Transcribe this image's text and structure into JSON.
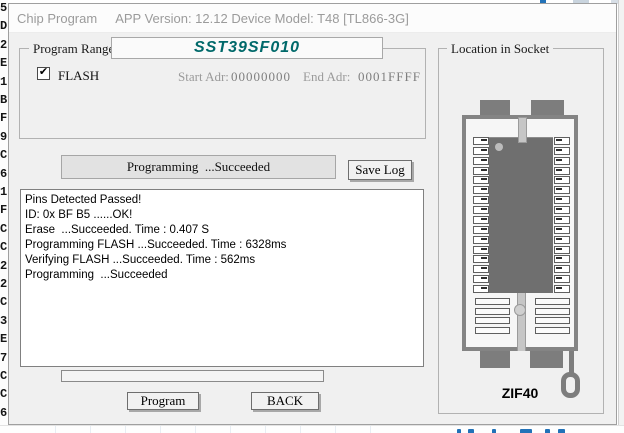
{
  "window": {
    "title_left": "Chip Program",
    "title_right": "APP Version: 12.12 Device Model: T48 [TL866-3G]"
  },
  "program_range": {
    "group_label": "Program Range",
    "chip_name": "SST39SF010",
    "flash_checkbox": {
      "label": "FLASH",
      "checked": true
    },
    "start_adr_label": "Start Adr:",
    "start_adr_value": "00000000",
    "end_adr_label": "End Adr:",
    "end_adr_value": "0001FFFF"
  },
  "status": {
    "message": "Programming  ...Succeeded",
    "save_log_button": "Save Log"
  },
  "log": {
    "lines": [
      "Pins Detected Passed!",
      "ID: 0x BF B5 ......OK!",
      "Erase  ...Succeeded. Time : 0.407 S",
      "Programming FLASH ...Succeeded. Time : 6328ms",
      "Verifying FLASH ...Succeeded. Time : 562ms",
      "Programming  ...Succeeded"
    ]
  },
  "progress": {
    "value_percent": 0
  },
  "actions": {
    "program_button": "Program",
    "back_button": "BACK"
  },
  "socket_panel": {
    "group_label": "Location in Socket",
    "socket_label": "ZIF40",
    "pin_rows_covered": 16,
    "pin_rows_empty": 4
  },
  "icons": {
    "checkbox_check": "✔"
  },
  "background_window": {
    "left_column_chars": [
      "5",
      "D",
      "2",
      "E",
      "1",
      "B",
      "F",
      "9",
      "C",
      "6",
      "1",
      "F",
      "C",
      "C",
      "2",
      "2",
      "C",
      "3",
      "E",
      "7",
      "C",
      "C",
      "6",
      "8"
    ],
    "accent_blue": "#2272b8"
  },
  "colors": {
    "chip_name_teal": "#00696a",
    "dialog_bg": "#f0f0f0",
    "titlebar_text": "#9b9b9b",
    "socket_gray": "#7d7d7d",
    "chip_gray": "#6f6f6f"
  }
}
